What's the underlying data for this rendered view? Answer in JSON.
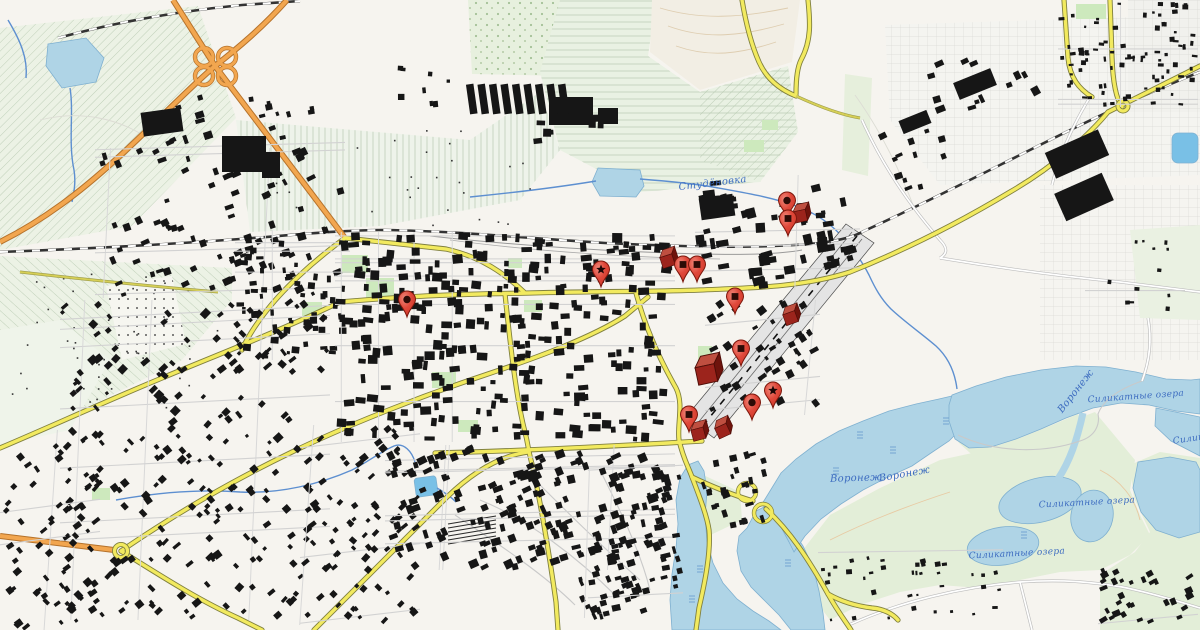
{
  "map": {
    "kind": "topographic-city-map",
    "water_labels": [
      {
        "text": "Студёновка",
        "x": 713,
        "y": 186,
        "rotate": -7,
        "size": 10
      },
      {
        "text": "Воронеж",
        "x": 856,
        "y": 481,
        "rotate": -2,
        "size": 10
      },
      {
        "text": "Воронеж",
        "x": 905,
        "y": 477,
        "rotate": -10,
        "size": 10
      },
      {
        "text": "Воронеж",
        "x": 1078,
        "y": 393,
        "rotate": -52,
        "size": 10
      },
      {
        "text": "Силикатные озера",
        "x": 1136,
        "y": 399,
        "rotate": -4,
        "size": 9
      },
      {
        "text": "Силикатные озера",
        "x": 1087,
        "y": 505,
        "rotate": -3,
        "size": 9
      },
      {
        "text": "Силикатные озера",
        "x": 1017,
        "y": 556,
        "rotate": -3,
        "size": 9
      },
      {
        "text": "Силикатные озера",
        "x": 1221,
        "y": 437,
        "rotate": -8,
        "size": 9
      }
    ],
    "markers": [
      {
        "type": "pin",
        "icon": "circle",
        "x": 407,
        "y": 317
      },
      {
        "type": "pin",
        "icon": "star",
        "x": 601,
        "y": 287
      },
      {
        "type": "box",
        "x": 667,
        "y": 259,
        "rotate": -18
      },
      {
        "type": "pin",
        "icon": "square",
        "x": 683,
        "y": 282
      },
      {
        "type": "pin",
        "icon": "square",
        "x": 697,
        "y": 282
      },
      {
        "type": "pin",
        "icon": "square",
        "x": 735,
        "y": 314
      },
      {
        "type": "pin",
        "icon": "circle",
        "x": 787,
        "y": 218
      },
      {
        "type": "pin",
        "icon": "square",
        "x": 788,
        "y": 236
      },
      {
        "type": "box",
        "x": 800,
        "y": 214,
        "rotate": -12
      },
      {
        "type": "box",
        "x": 790,
        "y": 316,
        "rotate": -20
      },
      {
        "type": "pin",
        "icon": "square",
        "x": 741,
        "y": 366
      },
      {
        "type": "box",
        "x": 706,
        "y": 371,
        "rotate": -12,
        "scale": 1.55
      },
      {
        "type": "pin",
        "icon": "star",
        "x": 773,
        "y": 408
      },
      {
        "type": "pin",
        "icon": "circle",
        "x": 752,
        "y": 420
      },
      {
        "type": "pin",
        "icon": "square",
        "x": 689,
        "y": 432
      },
      {
        "type": "box",
        "x": 698,
        "y": 432,
        "rotate": -15
      },
      {
        "type": "box",
        "x": 722,
        "y": 429,
        "rotate": -25
      }
    ],
    "colors": {
      "pin_red": "#e0493b",
      "pin_red_light": "#f08a7c",
      "pin_dark": "#7c170c",
      "pin_hole": "#2d0b06",
      "box_front": "#9c241c",
      "box_top": "#bf4f40",
      "box_side": "#6e130c",
      "box_edge": "#4e0d07",
      "label_blue": "#3d6cc0",
      "road_yellow": "#f2ea5f",
      "road_orange": "#f2a64f",
      "water": "#afd4e6",
      "water_bright": "#79c0e6",
      "building": "#161616"
    }
  }
}
